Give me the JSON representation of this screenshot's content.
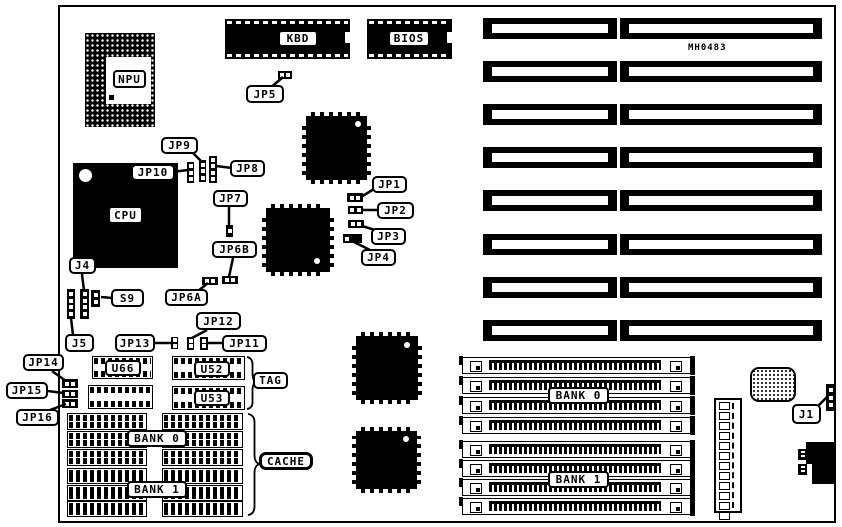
{
  "board": {
    "part_number": "MH0483"
  },
  "chips": {
    "npu": "NPU",
    "cpu": "CPU",
    "kbd": "KBD",
    "bios": "BIOS"
  },
  "jumpers": {
    "jp1": "JP1",
    "jp2": "JP2",
    "jp3": "JP3",
    "jp4": "JP4",
    "jp5": "JP5",
    "jp6a": "JP6A",
    "jp6b": "JP6B",
    "jp7": "JP7",
    "jp8": "JP8",
    "jp9": "JP9",
    "jp10": "JP10",
    "jp11": "JP11",
    "jp12": "JP12",
    "jp13": "JP13",
    "jp14": "JP14",
    "jp15": "JP15",
    "jp16": "JP16"
  },
  "connectors": {
    "j1": "J1",
    "j4": "J4",
    "j5": "J5",
    "s9": "S9"
  },
  "cache": {
    "u66": "U66",
    "u52": "U52",
    "u53": "U53",
    "tag": "TAG",
    "cache": "CACHE",
    "bank0": "BANK 0",
    "bank1": "BANK 1"
  },
  "simm": {
    "bank0": "BANK 0",
    "bank1": "BANK 1"
  }
}
